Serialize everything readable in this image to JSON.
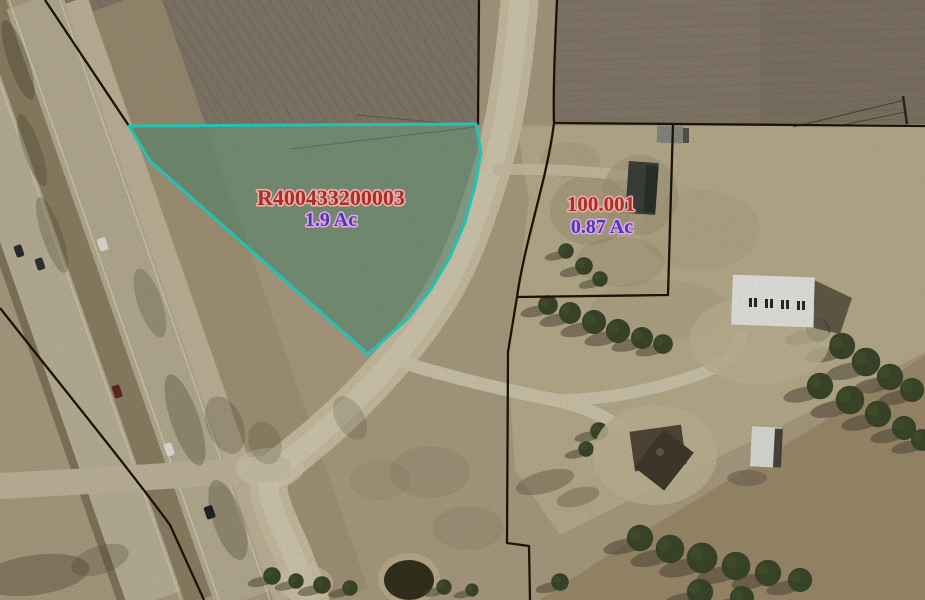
{
  "map_annotations": {
    "boundary_line_color": "#201808",
    "parcels": {
      "highlighted": {
        "parcel_id": "R400433200003",
        "area_label": "1.9 Ac",
        "outline_color": "#27e0d0",
        "fill_color": "rgba(68,142,116,0.48)",
        "id_text_color": "#a43029",
        "id_halo_color": "#f2aba6",
        "area_text_color": "#4b3ab8",
        "area_halo_color": "#e2a6de"
      },
      "neighbor": {
        "parcel_id": "100.001",
        "area_label": "0.87 Ac",
        "id_text_color": "#a43029",
        "id_halo_color": "#f2aba6",
        "area_text_color": "#4b3ab8",
        "area_halo_color": "#e2a6de"
      }
    }
  }
}
